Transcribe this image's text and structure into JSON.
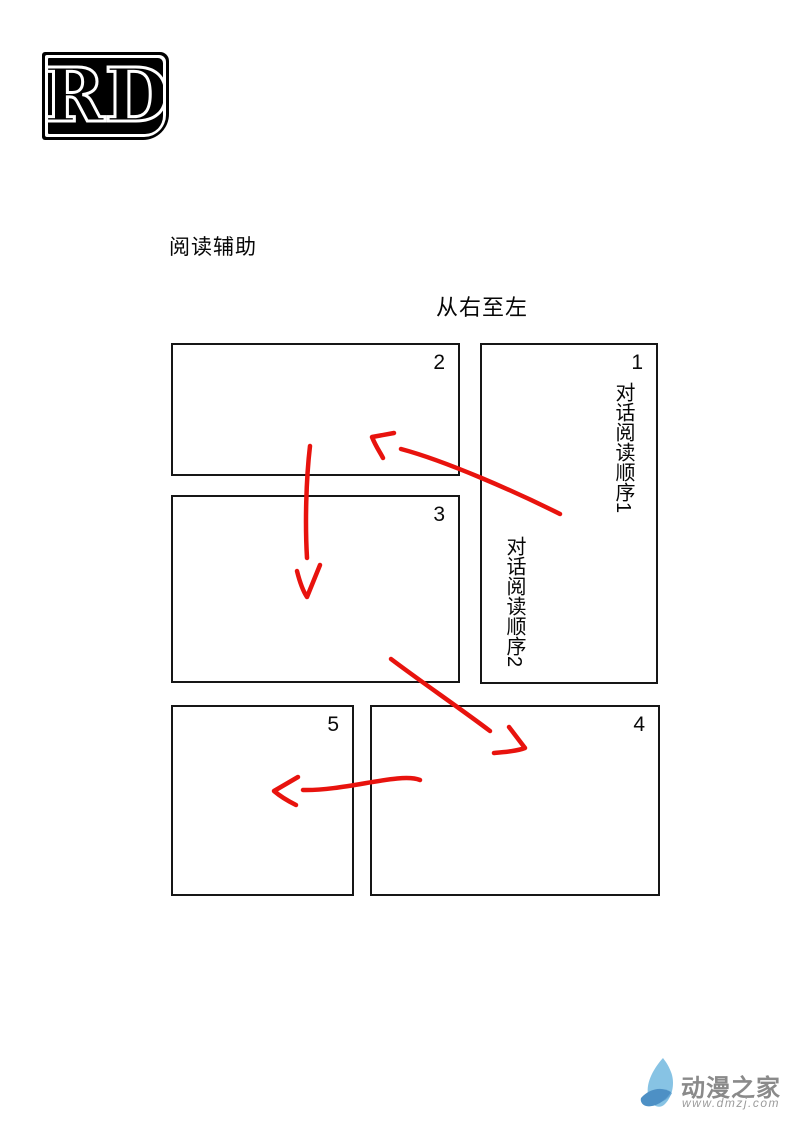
{
  "logo": {
    "letters": "RD"
  },
  "headings": {
    "reading_aid": "阅读辅助",
    "direction": "从右至左"
  },
  "panels": [
    {
      "number": "1"
    },
    {
      "number": "2"
    },
    {
      "number": "3"
    },
    {
      "number": "4"
    },
    {
      "number": "5"
    }
  ],
  "vertical_notes": [
    {
      "text": "对话阅读顺序1"
    },
    {
      "text": "对话阅读顺序2"
    }
  ],
  "watermark": {
    "site_name": "动漫之家",
    "site_url": "www.dmzj.com"
  },
  "colors": {
    "arrow_red": "#e8130e",
    "panel_border": "#161616",
    "logo_black": "#000000",
    "flame_light": "#87c3e4",
    "flame_mid": "#6aa9d6",
    "flame_dark": "#4d90c5",
    "watermark_gray": "#8a8a8a"
  }
}
